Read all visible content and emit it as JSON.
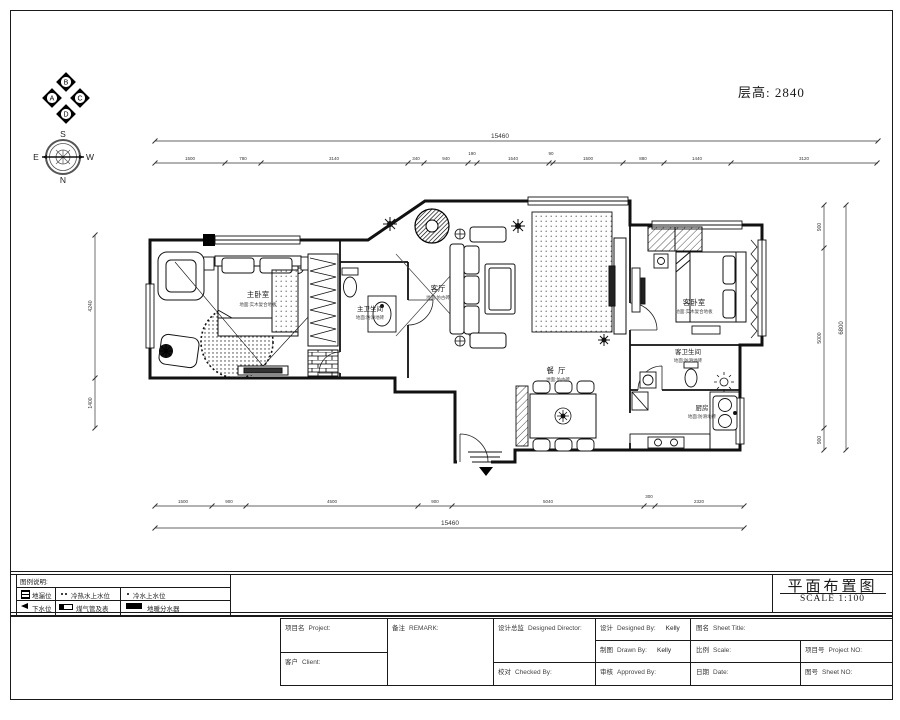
{
  "page": {
    "floor_height": "层高: 2840"
  },
  "compass": {
    "markers": [
      "A",
      "B",
      "C",
      "D"
    ],
    "dirs": [
      "S",
      "E",
      "W",
      "N"
    ]
  },
  "rooms": [
    {
      "name": "主卧室",
      "sub": "地面:实木复合地板"
    },
    {
      "name": "主卫生间",
      "sub": "地面:防滑地砖"
    },
    {
      "name": "客厅",
      "sub": "地面:仿古砖"
    },
    {
      "name": "客卧室",
      "sub": "地面:实木复合地板"
    },
    {
      "name": "餐厅",
      "sub": "地面:仿古砖"
    },
    {
      "name": "客卫生间",
      "sub": "地面:防滑地砖"
    },
    {
      "name": "厨房",
      "sub": "地面:防滑地砖"
    }
  ],
  "dims": {
    "top_total": "15460",
    "top": [
      "1500",
      "780",
      "3140",
      "340",
      "940",
      "190",
      "1540",
      "90",
      "1500",
      "880",
      "1440",
      "3120"
    ],
    "bottom": [
      "1500",
      "900",
      "4500",
      "900",
      "5040",
      "300",
      "2320"
    ],
    "bottom_total": "15460",
    "left": [
      "4240",
      "1400"
    ],
    "right": [
      "900",
      "5000",
      "900"
    ],
    "right_total": "6800"
  },
  "legend": {
    "title": "图例说明:",
    "items": [
      {
        "icon": "floor-drain-icon",
        "label": "地漏位"
      },
      {
        "icon": "hot-cold-water-icon",
        "label": "冷热水上水位"
      },
      {
        "icon": "cold-water-icon",
        "label": "冷水上水位"
      },
      {
        "icon": "drain-pipe-icon",
        "label": "下水位"
      },
      {
        "icon": "gas-meter-icon",
        "label": "煤气管及表"
      },
      {
        "icon": "manifold-icon",
        "label": "地暖分水器"
      }
    ]
  },
  "sheet": {
    "title": "平面布置图",
    "scale": "SCALE 1:100"
  },
  "titleblock": {
    "project_cn": "项目名",
    "project_en": "Project:",
    "client_cn": "客户",
    "client_en": "Client:",
    "remark_cn": "备注",
    "remark_en": "REMARK:",
    "director_cn": "设计总监",
    "director_en": "Designed Director:",
    "checked_cn": "校对",
    "checked_en": "Checked By:",
    "designed_cn": "设计",
    "designed_en": "Designed By:",
    "designed_val": "Kelly",
    "drawn_cn": "制图",
    "drawn_en": "Drawn By:",
    "drawn_val": "Kelly",
    "approved_cn": "审核",
    "approved_en": "Approved By:",
    "sheetname_cn": "图名",
    "sheetname_en": "Sheet Title:",
    "scale_cn": "比例",
    "scale_en": "Scale:",
    "date_cn": "日期",
    "date_en": "Date:",
    "projno_cn": "项目号",
    "projno_en": "Project NO:",
    "sheetno_cn": "图号",
    "sheetno_en": "Sheet NO:"
  }
}
